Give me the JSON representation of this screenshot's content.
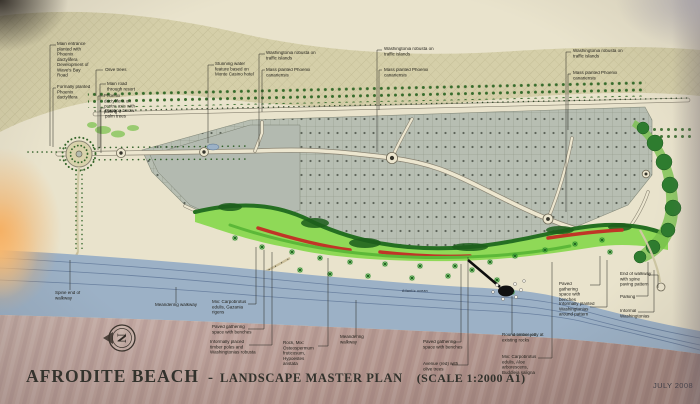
{
  "document": {
    "title": "AFRODITE BEACH",
    "separator": "-",
    "subtitle": "LANDSCAPE MASTER PLAN",
    "scale": "(SCALE 1:2000 A1)",
    "date": "JULY 2008"
  },
  "map_labels": {
    "atlantic_ocean": "Atlantic ocean",
    "north_letter": "N"
  },
  "annotations": {
    "main_entrance": "Main entrance planted with Phoenix dactylifera Development of Wave's Bay Road",
    "formal_phoenix": "Formally planted Phoenix dactylifera",
    "olive_trees": "Olive trees",
    "main_road": "Main road through resort",
    "phoenix_axis": "Phoenix dactylifera on centre axis with paving",
    "planting_palms": "Planting below palm trees",
    "water_feature": "Stunning water feature based on Monte Casino hotel",
    "washingtonia_islands": "Washingtonia robusta on traffic islands",
    "mass_phoenix": "Mass planted Phoenix canariensis",
    "spine_end": "Spine end of walkway",
    "meandering_walkway": "Meandering walkway",
    "mix_carpobrotus_gazania": "Mix: Carpobrotus edulis, Gazania rigens",
    "paved_gathering": "Paved gathering space with benches",
    "timber_poles": "Informally placed timber poles and Washingtonias robusta",
    "rock_mix": "Rock, Mix: Osteospermum fruticosum, Hypoestes aristata",
    "avenue_olives": "Avenue (red) with olive trees",
    "round_jetty": "Round timber jetty at existing rocks",
    "mix_carpobrotus_aloe": "Mix: Carpobrotus edulis, Aloe arborescens, Buddleja saligna",
    "washingtonias_around": "Informally planted Washingtonias around pattern",
    "end_walkway": "End of walkway with spine paving pattern",
    "parking": "Parking",
    "informal_washingtonias": "Informal Washingtonias"
  },
  "colors": {
    "paper": "#e9e3cc",
    "dune_hatch": "#d5cfa9",
    "parcel_grey": "#b7beb2",
    "lawn_green": "#8fd957",
    "tree_dark_green": "#20641f",
    "flower_red": "#c03527",
    "sea_blue": "#9cb1c6",
    "sand_mauve": "#b79b93"
  }
}
